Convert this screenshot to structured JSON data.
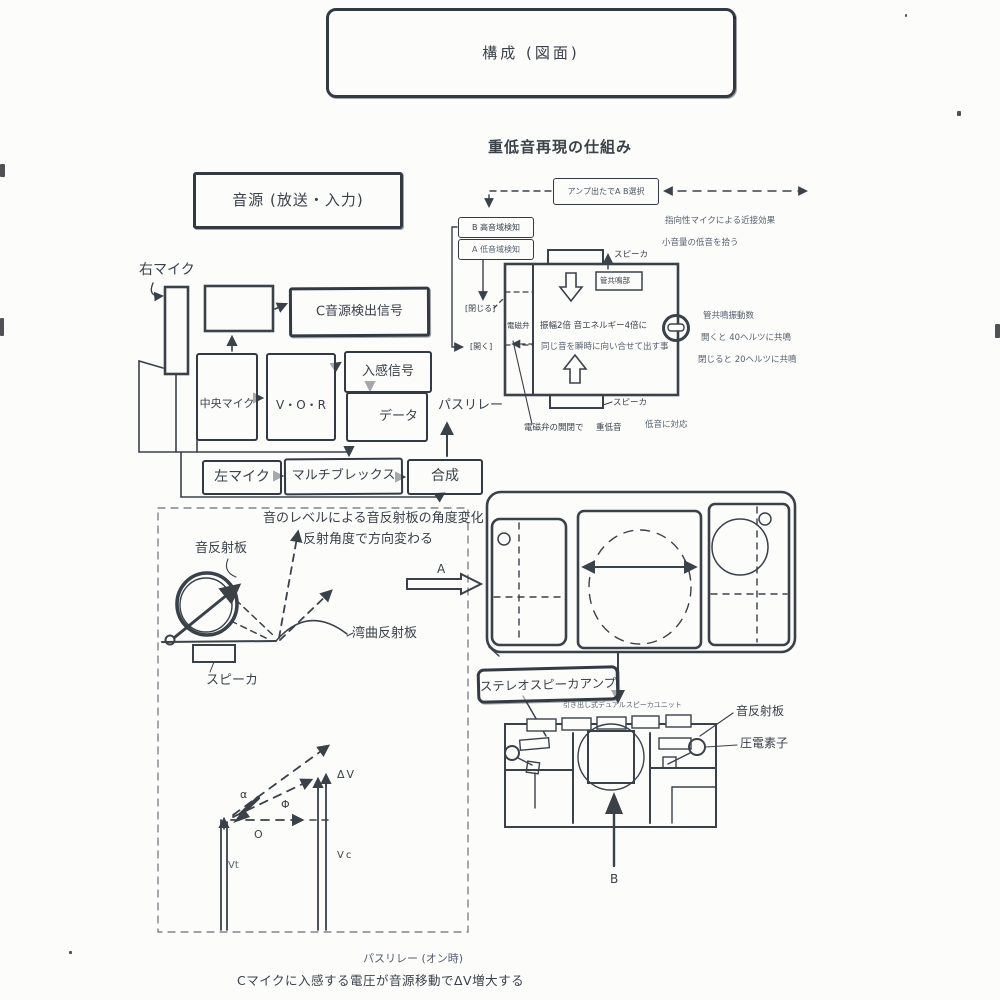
{
  "title": "構成 (図面)",
  "subtitle": "重低音再現の仕組み",
  "source_box": "音源 (放送・入力)",
  "mic_flow": {
    "right_mic": "右マイク",
    "c_signal": "C音源検出信号",
    "center_mic": "中央マイク",
    "vor": "V・O・R",
    "incoming_signal": "入感信号",
    "data_box": "データ",
    "left_mic": "左マイク",
    "multiplex": "マルチブレックス",
    "compose": "合成",
    "pass_relay": "パスリレー"
  },
  "bass_system": {
    "amp_select": "アンプ出たでA B選択",
    "proximity_note": "指向性マイクによる近接効果",
    "detect_high": "B 高音域検知",
    "detect_low": "A 低音域検知",
    "small_volume_note": "小音量の低音を拾う",
    "speaker_top": "スピーカ",
    "pipe_resonator": "管共鳴部",
    "solenoid_valve": "電磁弁",
    "close_label": "[閉じる]",
    "open_label": "[開く]",
    "amplitude_note": "振幅2倍 音エネルギー4倍に",
    "simultaneous_note": "同じ音を瞬時に向い合せて出す事",
    "resonance_title": "管共鳴振動数",
    "resonance_open": "開くと 40ヘルツに共鳴",
    "resonance_closed": "閉じると 20ヘルツに共鳴",
    "speaker_bottom": "スピーカ",
    "valve_note": "電磁弁の開閉で",
    "deep_bass": "重低音",
    "bass_support": "低音に対応"
  },
  "reflector": {
    "caption1": "音のレベルによる音反射板の角度変化",
    "caption2": "反射角度で方向変わる",
    "sound_reflector": "音反射板",
    "curved_reflector": "湾曲反射板",
    "speaker": "スピーカ",
    "arrow_a": "A"
  },
  "speaker_unit": {
    "stereo_amp": "ステレオスピーカアンプ",
    "unit_caption": "引き出し式デュアルスピーカユニット",
    "sound_reflector": "音反射板",
    "piezo": "圧電素子",
    "arrow_b": "B"
  },
  "vector_diagram": {
    "delta_v": "ΔV",
    "alpha": "α",
    "phi": "Φ",
    "origin": "O",
    "vc": "Vc",
    "vt": "Vt"
  },
  "footer": {
    "pass_relay_on": "パスリレー (オン時)",
    "note": "Cマイクに入感する電圧が音源移動でΔV増大する"
  },
  "ink_color": "#3a4149"
}
